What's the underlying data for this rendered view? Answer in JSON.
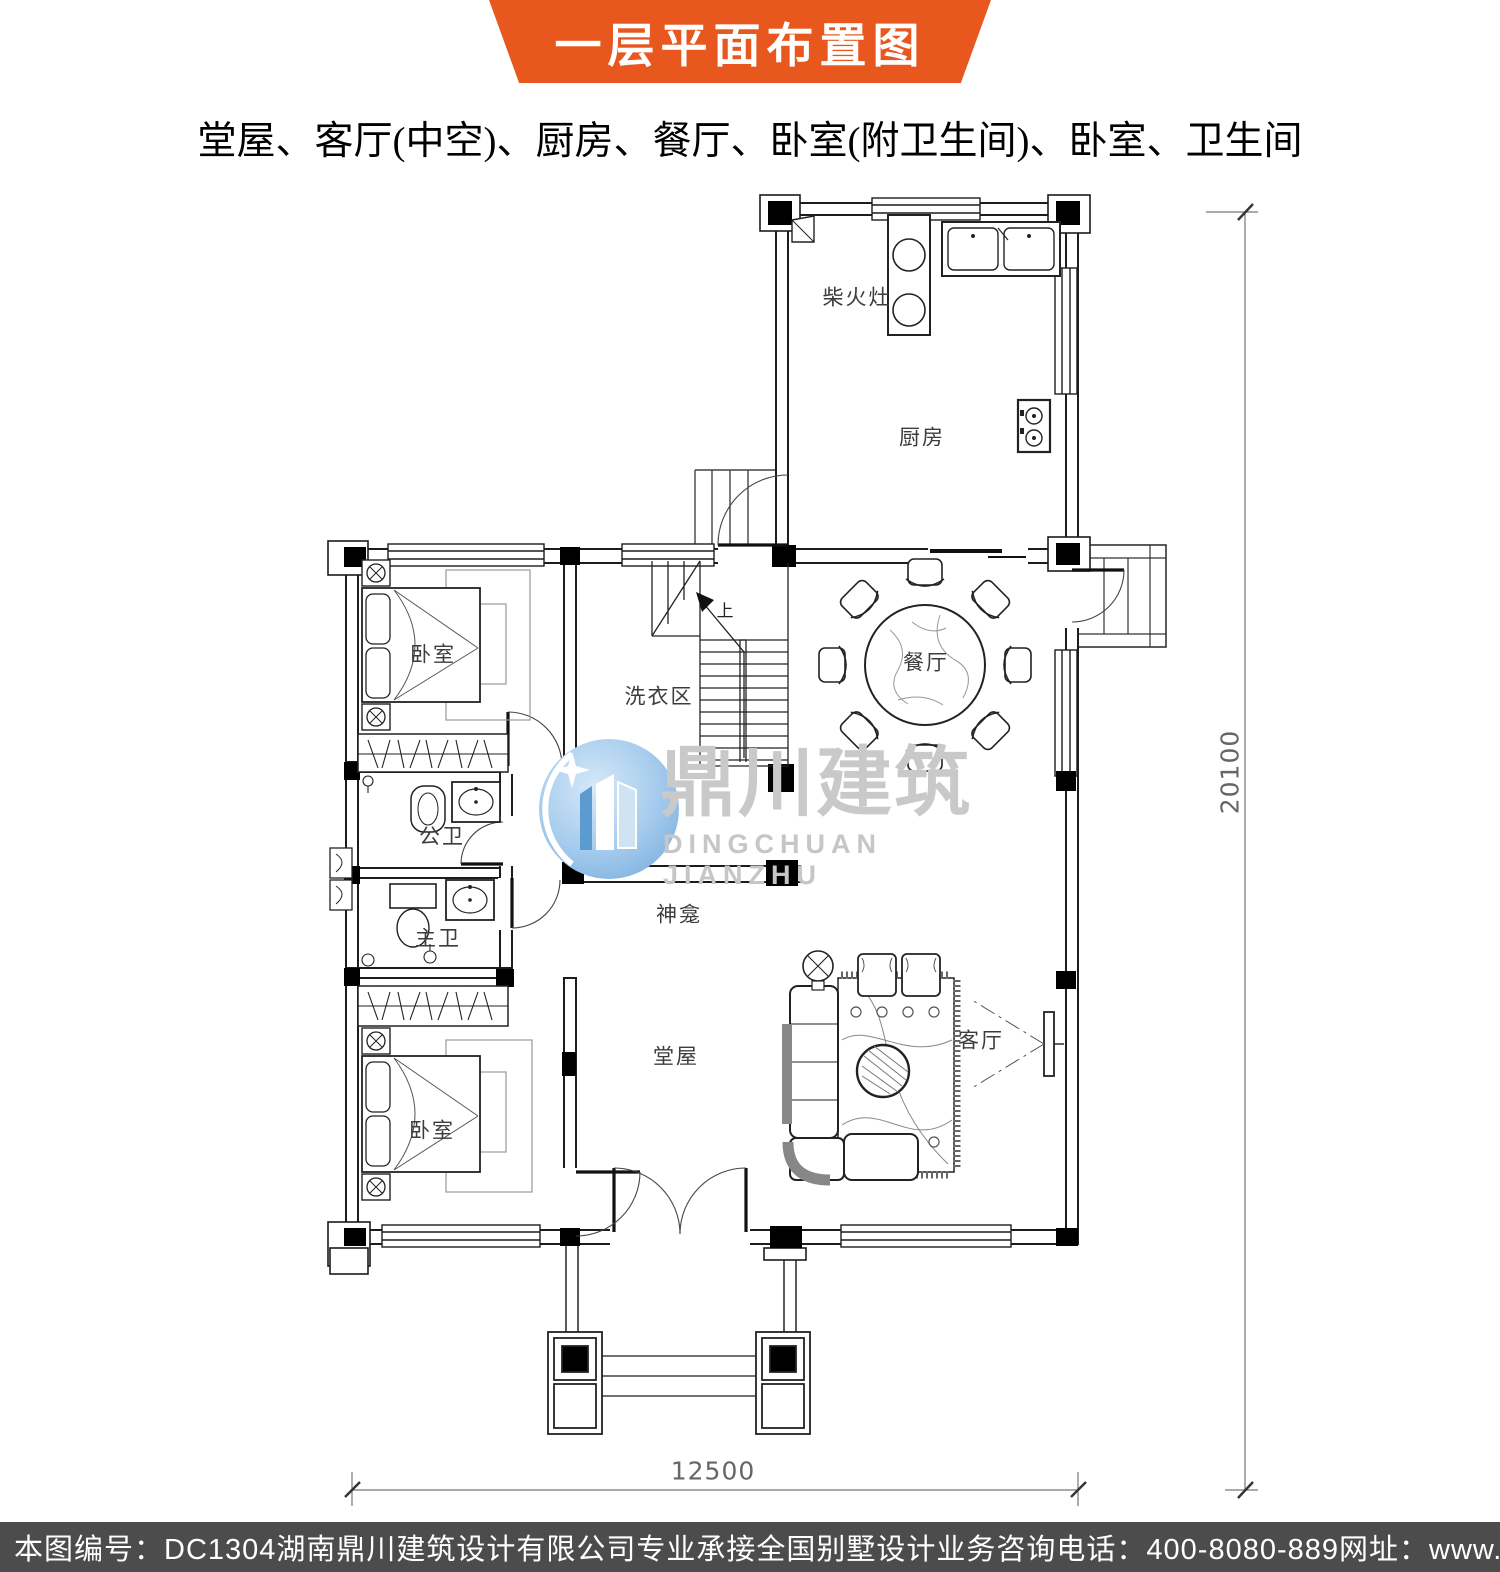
{
  "header": {
    "banner_title": "一层平面布置图",
    "subtitle": "堂屋、客厅(中空)、厨房、餐厅、卧室(附卫生间)、卧室、卫生间"
  },
  "plan": {
    "rooms": {
      "wood_stove": "柴火灶",
      "kitchen": "厨房",
      "bedroom_top": "卧室",
      "laundry": "洗衣区",
      "dining": "餐厅",
      "public_bath": "公卫",
      "master_bath": "主卫",
      "shrine": "神龛",
      "main_hall": "堂屋",
      "living": "客厅",
      "bedroom_bottom": "卧室"
    },
    "stairs_up_label": "上",
    "dimensions": {
      "width_mm": "12500",
      "height_mm": "20100"
    }
  },
  "watermark": {
    "logo_cn": "鼎川建筑",
    "logo_en": "DINGCHUAN JIANZHU"
  },
  "footer": {
    "sheet_no": "本图编号：DC1304",
    "company": "湖南鼎川建筑设计有限公司专业承接全国别墅设计业务",
    "phone": "咨询电话：400-8080-889",
    "website": "网址：www.bstzcs.com"
  },
  "colors": {
    "banner": "#E8571D",
    "footer_bg": "#4C4C4C",
    "watermark_blue": "#8FBFE8",
    "watermark_text": "#C9C9C9"
  }
}
